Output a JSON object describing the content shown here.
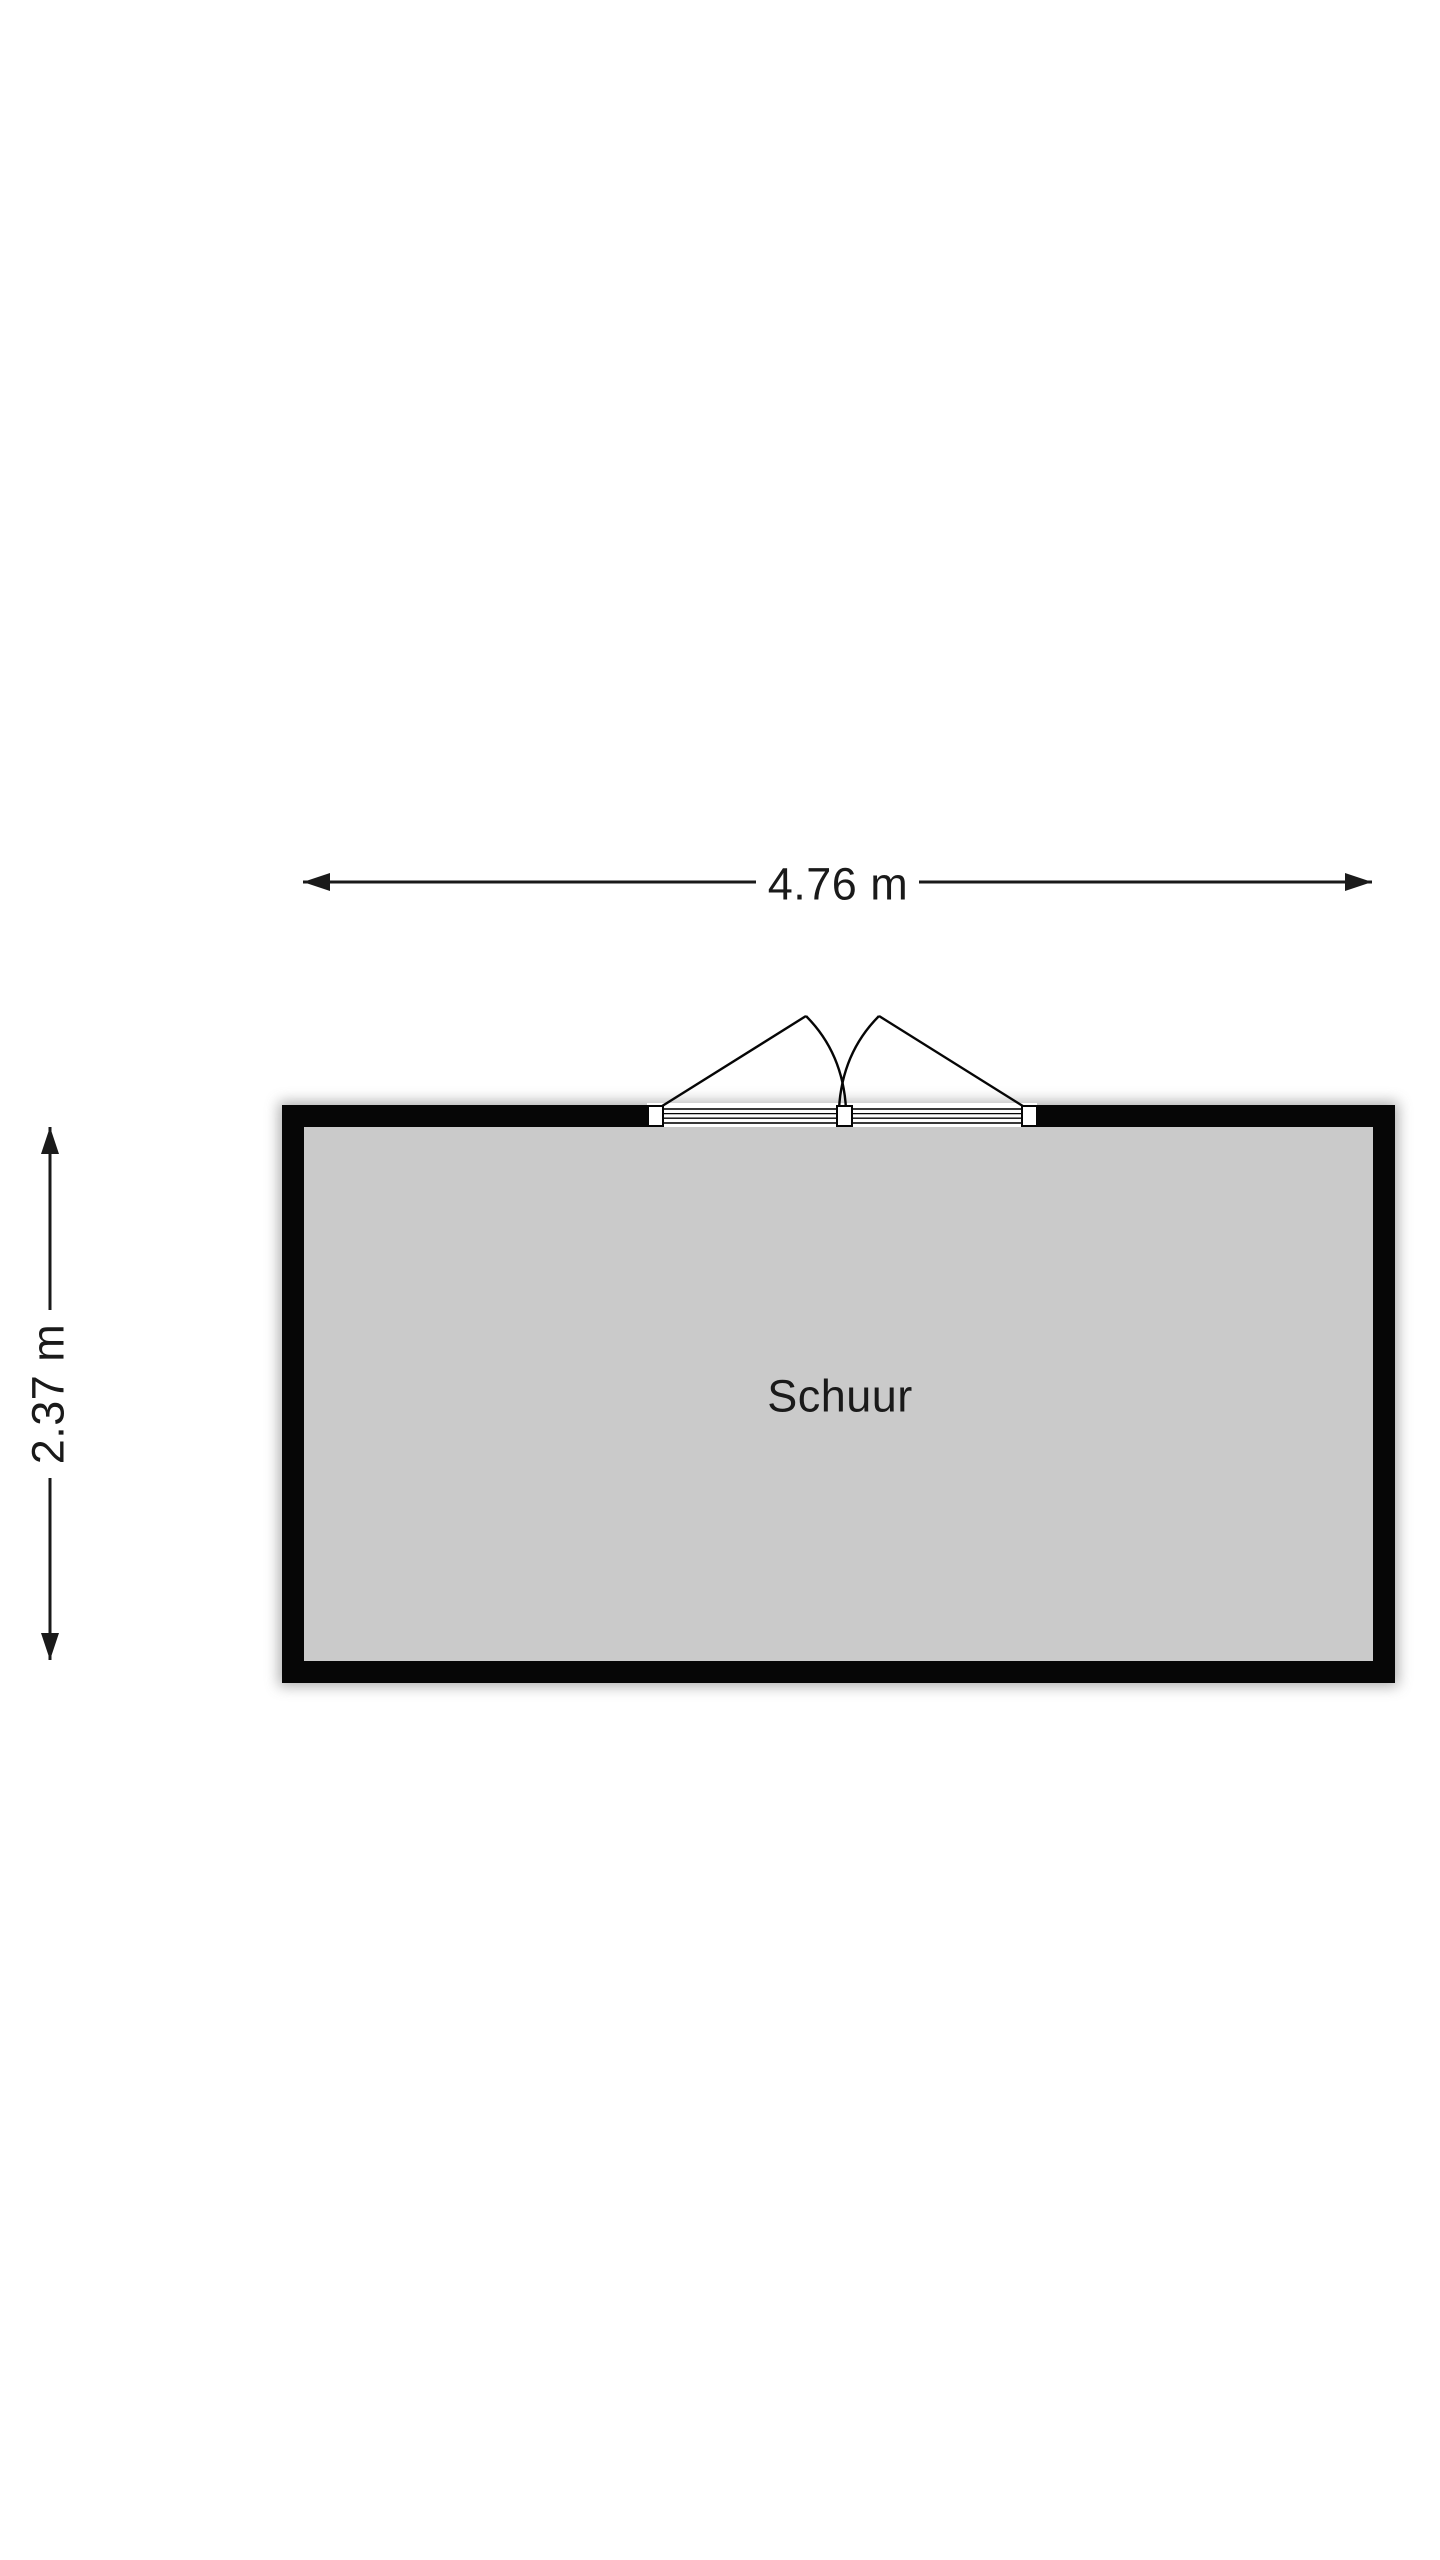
{
  "floorplan": {
    "room": {
      "name": "Schuur"
    },
    "dimensions": {
      "width": "4.76 m",
      "height": "2.37 m"
    },
    "door": {
      "symbol": "double-swing-door",
      "wall": "top"
    },
    "colors": {
      "background": "#ffffff",
      "wall": "#060606",
      "floor": "#cacaca",
      "dimension_line": "#1a1a1a",
      "text": "#1a1a1a",
      "shadow": "#8f8f8f"
    }
  }
}
